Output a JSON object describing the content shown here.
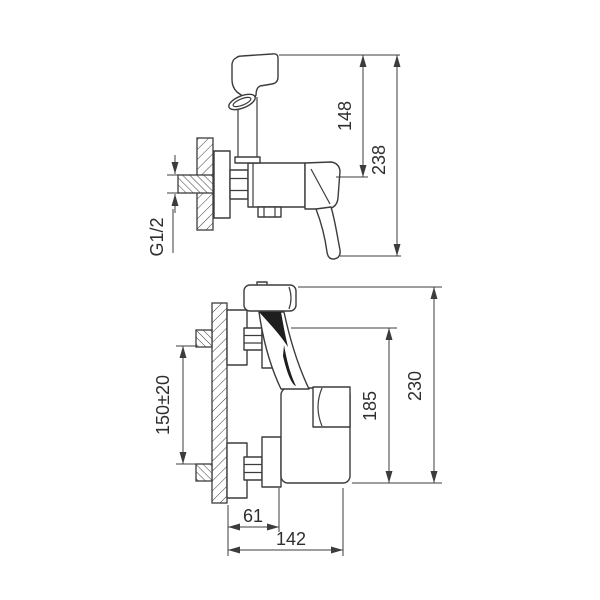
{
  "drawing": {
    "background": "#ffffff",
    "stroke_color": "#3c3c3c",
    "text_color": "#2e2e2e",
    "views": {
      "side_view": {
        "label": "side view",
        "dims": {
          "thread_size": "G1/2",
          "holder_height": "148",
          "overall_height": "238"
        }
      },
      "front_view": {
        "label": "front view",
        "dims": {
          "inlet_spacing": "150±20",
          "body_height": "185",
          "overall_height": "230",
          "wall_offset": "61",
          "overall_depth": "142"
        }
      }
    }
  }
}
